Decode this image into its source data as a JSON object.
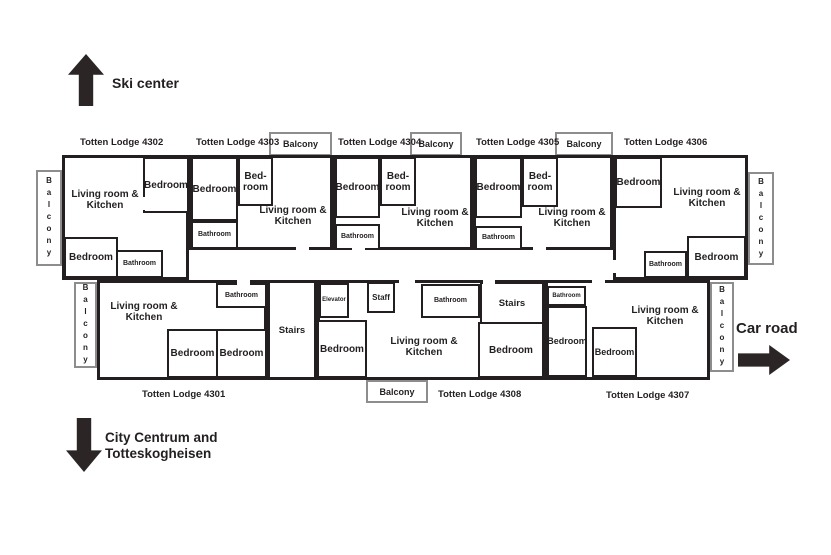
{
  "diagram": {
    "type": "floor-plan",
    "building": "Totten Lodge"
  },
  "directions": {
    "ski": "Ski center",
    "city_line1": "City Centrum and",
    "city_line2": "Totteskogheisen",
    "car": "Car road"
  },
  "lodges": {
    "l4301": "Totten Lodge 4301",
    "l4302": "Totten Lodge 4302",
    "l4303": "Totten Lodge 4303",
    "l4304": "Totten Lodge 4304",
    "l4305": "Totten Lodge 4305",
    "l4306": "Totten Lodge 4306",
    "l4307": "Totten Lodge 4307",
    "l4308": "Totten Lodge 4308"
  },
  "rooms": {
    "living": "Living room & Kitchen",
    "bedroom": "Bedroom",
    "bed_l1": "Bed-",
    "bed_l2": "room",
    "bathroom": "Bathroom",
    "balcony": "Balcony",
    "stairs": "Stairs",
    "elevator": "Elevator",
    "staff": "Staff"
  },
  "colors": {
    "wall": "#231f20",
    "balcony_border": "#8d8d8d",
    "arrow": "#2b2525",
    "background": "#ffffff"
  }
}
